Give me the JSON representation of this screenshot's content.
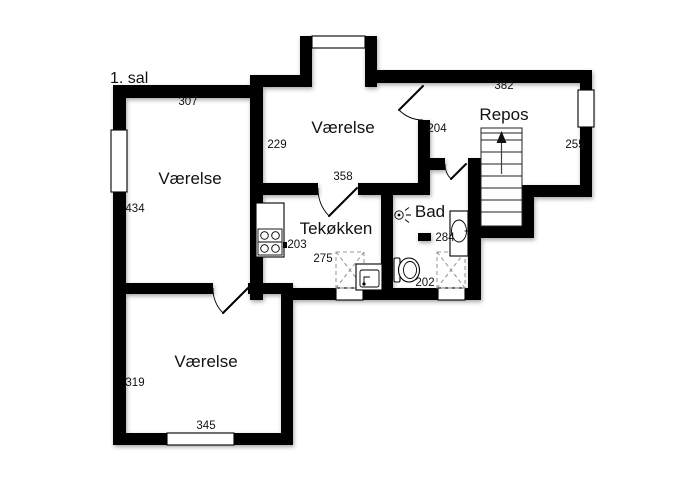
{
  "floorplan": {
    "floor_label": "1. sal",
    "rooms": {
      "room_left": {
        "label": "Værelse",
        "dim_width": "307",
        "dim_height": "434"
      },
      "room_top": {
        "label": "Værelse",
        "dim_height": "229",
        "dim_door": "358"
      },
      "repos": {
        "label": "Repos",
        "dim_width": "382",
        "dim_height": "255"
      },
      "hall": {
        "dim_door": "204"
      },
      "kitchen": {
        "label": "Tekøkken",
        "dim_height": "203",
        "dim_width": "275"
      },
      "bath": {
        "label": "Bad",
        "dim_width": "284",
        "dim_bottom": "202"
      },
      "room_bottom": {
        "label": "Værelse",
        "dim_height": "319",
        "dim_width": "345"
      }
    },
    "icons": {
      "stairs": "stairs-up-arrow",
      "cooktop": "cooktop-four-burners",
      "kitchen_sink": "kitchen-sink",
      "washer": "dashed-appliance-cross",
      "toilet": "toilet",
      "shower": "dashed-appliance-cross",
      "bath_sink": "bathroom-sink",
      "lamp": "wall-lamp"
    },
    "colors": {
      "wall": "#000000",
      "background": "#ffffff",
      "text": "#111111",
      "dashed": "#9a9a9a"
    }
  }
}
